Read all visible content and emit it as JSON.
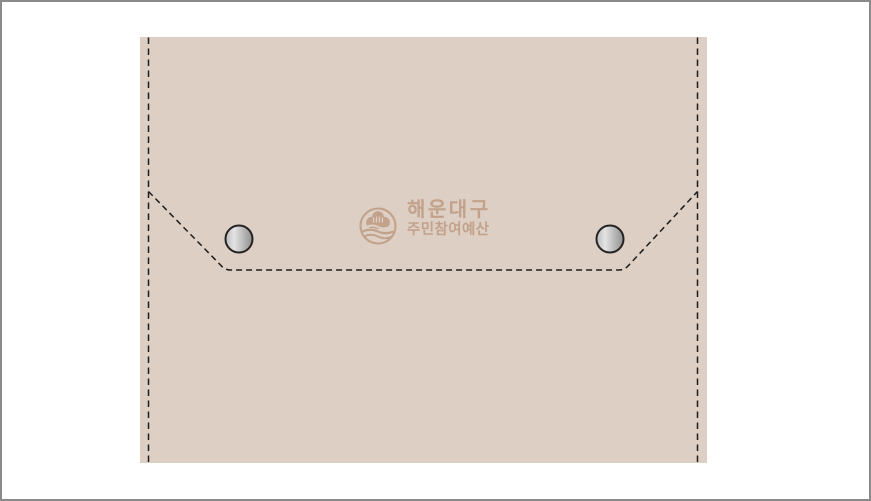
{
  "canvas": {
    "width_px": 871,
    "height_px": 501,
    "background_color": "#ffffff",
    "frame_border_color": "#8a8a8a"
  },
  "pouch": {
    "description": "envelope-style fabric snap pouch mockup with flap stitch guides",
    "fabric_color": "#ddcfc3",
    "stitch_color": "#1d1d1d",
    "snap_buttons": {
      "icon": "metal-snap-button-icon",
      "count": 2,
      "rim_color": "#232323",
      "metal_light_color": "#e3e3e3",
      "metal_dark_color": "#8f8f8f"
    }
  },
  "logo": {
    "emblem_icon": "haeundae-gu-wave-emblem-icon",
    "color": "#c2a28b",
    "org_name": "해운대구",
    "program_name": "주민참여예산"
  }
}
